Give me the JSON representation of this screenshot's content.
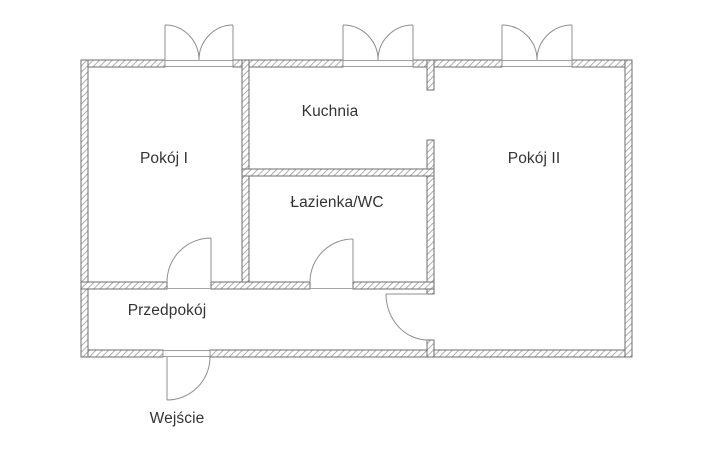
{
  "diagram_type": "apartment-floor-plan",
  "rooms": {
    "room_1": {
      "label": "Pokój I"
    },
    "kitchen": {
      "label": "Kuchnia"
    },
    "bathroom": {
      "label": "Łazienka/WC"
    },
    "room_2": {
      "label": "Pokój II"
    },
    "hallway": {
      "label": "Przedpokój"
    }
  },
  "entrance": {
    "label": "Wejście"
  },
  "features": {
    "windows_count": 3,
    "interior_doors_count": 3,
    "entrance_doors_count": 1,
    "open_passages_count": 1
  },
  "colors": {
    "background": "#ffffff",
    "wall_outline": "#6e6e6e",
    "wall_hatch": "#a6a6a6",
    "fixture_line": "#8f8f8f",
    "text": "#333333"
  }
}
